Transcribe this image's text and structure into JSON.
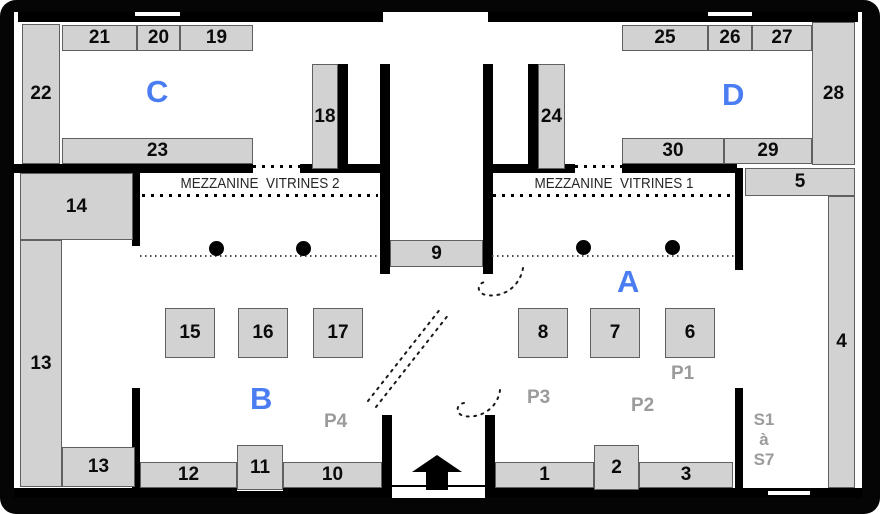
{
  "plan_title": "museum-floor-plan",
  "colors": {
    "wall": "#000000",
    "vitrine_fill": "#d2d2d2",
    "vitrine_border": "#606060",
    "zone_label": "#4a7cf2",
    "path_label": "#9b9b9b",
    "number_text": "#0b0b0b"
  },
  "mezzanine": {
    "left": "MEZZANINE  VITRINES 2",
    "right": "MEZZANINE  VITRINES 1"
  },
  "zones": [
    {
      "id": "C",
      "label": "C",
      "x": 146,
      "y": 76
    },
    {
      "id": "D",
      "label": "D",
      "x": 722,
      "y": 79
    },
    {
      "id": "B",
      "label": "B",
      "x": 250,
      "y": 383
    },
    {
      "id": "A",
      "label": "A",
      "x": 617,
      "y": 266
    }
  ],
  "vitrines": [
    {
      "id": "21",
      "label": "21",
      "x": 62,
      "y": 25,
      "w": 75,
      "h": 26
    },
    {
      "id": "20",
      "label": "20",
      "x": 137,
      "y": 25,
      "w": 43,
      "h": 26
    },
    {
      "id": "19",
      "label": "19",
      "x": 180,
      "y": 25,
      "w": 73,
      "h": 26
    },
    {
      "id": "22",
      "label": "22",
      "x": 22,
      "y": 24,
      "w": 38,
      "h": 140
    },
    {
      "id": "23",
      "label": "23",
      "x": 62,
      "y": 138,
      "w": 191,
      "h": 26
    },
    {
      "id": "18",
      "label": "18",
      "x": 312,
      "y": 64,
      "w": 26,
      "h": 105
    },
    {
      "id": "25",
      "label": "25",
      "x": 622,
      "y": 25,
      "w": 86,
      "h": 26
    },
    {
      "id": "26",
      "label": "26",
      "x": 708,
      "y": 25,
      "w": 44,
      "h": 26
    },
    {
      "id": "27",
      "label": "27",
      "x": 752,
      "y": 25,
      "w": 60,
      "h": 26
    },
    {
      "id": "28",
      "label": "28",
      "x": 812,
      "y": 22,
      "w": 43,
      "h": 143
    },
    {
      "id": "24",
      "label": "24",
      "x": 538,
      "y": 64,
      "w": 27,
      "h": 105
    },
    {
      "id": "30",
      "label": "30",
      "x": 622,
      "y": 138,
      "w": 102,
      "h": 26
    },
    {
      "id": "29",
      "label": "29",
      "x": 724,
      "y": 138,
      "w": 88,
      "h": 26
    },
    {
      "id": "5",
      "label": "5",
      "x": 745,
      "y": 168,
      "w": 110,
      "h": 28
    },
    {
      "id": "4",
      "label": "4",
      "x": 828,
      "y": 196,
      "w": 27,
      "h": 292
    },
    {
      "id": "14",
      "label": "14",
      "x": 20,
      "y": 173,
      "w": 113,
      "h": 67
    },
    {
      "id": "13",
      "label": "13",
      "x": 20,
      "y": 240,
      "w": 42,
      "h": 247
    },
    {
      "id": "13b",
      "label": "13",
      "x": 62,
      "y": 447,
      "w": 73,
      "h": 40
    },
    {
      "id": "9",
      "label": "9",
      "x": 390,
      "y": 240,
      "w": 93,
      "h": 27
    },
    {
      "id": "15",
      "label": "15",
      "x": 165,
      "y": 308,
      "w": 50,
      "h": 50
    },
    {
      "id": "16",
      "label": "16",
      "x": 238,
      "y": 308,
      "w": 50,
      "h": 50
    },
    {
      "id": "17",
      "label": "17",
      "x": 313,
      "y": 308,
      "w": 50,
      "h": 50
    },
    {
      "id": "8",
      "label": "8",
      "x": 518,
      "y": 308,
      "w": 50,
      "h": 50
    },
    {
      "id": "7",
      "label": "7",
      "x": 590,
      "y": 308,
      "w": 50,
      "h": 50
    },
    {
      "id": "6",
      "label": "6",
      "x": 665,
      "y": 308,
      "w": 50,
      "h": 50
    },
    {
      "id": "12",
      "label": "12",
      "x": 140,
      "y": 462,
      "w": 97,
      "h": 26
    },
    {
      "id": "11",
      "label": "11",
      "x": 237,
      "y": 445,
      "w": 46,
      "h": 45
    },
    {
      "id": "10",
      "label": "10",
      "x": 283,
      "y": 462,
      "w": 99,
      "h": 26
    },
    {
      "id": "1",
      "label": "1",
      "x": 495,
      "y": 462,
      "w": 99,
      "h": 26
    },
    {
      "id": "2",
      "label": "2",
      "x": 594,
      "y": 445,
      "w": 45,
      "h": 45
    },
    {
      "id": "3",
      "label": "3",
      "x": 639,
      "y": 462,
      "w": 94,
      "h": 26
    }
  ],
  "path_labels": [
    {
      "id": "P1",
      "label": "P1",
      "x": 671,
      "y": 364
    },
    {
      "id": "P2",
      "label": "P2",
      "x": 631,
      "y": 396
    },
    {
      "id": "P3",
      "label": "P3",
      "x": 527,
      "y": 388
    },
    {
      "id": "P4",
      "label": "P4",
      "x": 324,
      "y": 412
    }
  ],
  "stairs": {
    "lines": [
      "S1",
      "à",
      "S7"
    ],
    "x": 744,
    "y": 410
  },
  "columns": [
    {
      "x": 209,
      "y": 241
    },
    {
      "x": 296,
      "y": 241
    },
    {
      "x": 576,
      "y": 240
    },
    {
      "x": 665,
      "y": 240
    }
  ]
}
